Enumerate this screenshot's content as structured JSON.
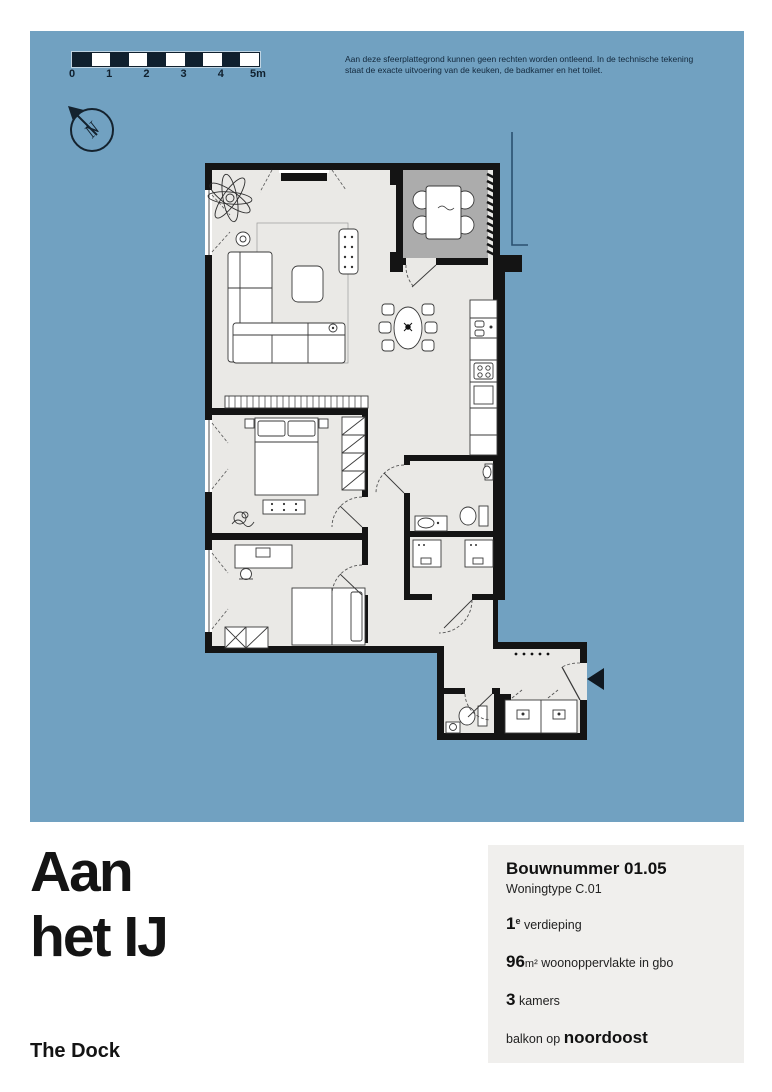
{
  "plan_board": {
    "background_color": "#71a1c1",
    "scale_bar": {
      "labels": [
        "0",
        "1",
        "2",
        "3",
        "4",
        "5m"
      ]
    },
    "compass": {
      "label": "N"
    },
    "disclaimer": {
      "line1": "Aan deze sfeerplattegrond kunnen geen rechten worden ontleend. In de technische tekening",
      "line2": "staat de exacte uitvoering van de keuken, de badkamer en het toilet."
    },
    "floorplan": {
      "wall_color": "#141414",
      "floor_color": "#eae9e6",
      "balcony_color": "#acacac"
    }
  },
  "footer": {
    "title_line1": "Aan",
    "title_line2": "het IJ",
    "project_name": "The Dock",
    "info_panel": {
      "bouwnummer": "Bouwnummer 01.05",
      "woningtype": "Woningtype C.01",
      "floor": {
        "value": "1",
        "sup": "e",
        "label": "verdieping"
      },
      "area": {
        "value": "96",
        "unit": "m²",
        "label": "woonoppervlakte in gbo"
      },
      "rooms": {
        "value": "3",
        "label": "kamers"
      },
      "balcony": {
        "prefix": "balkon op",
        "value": "noordoost"
      }
    }
  }
}
